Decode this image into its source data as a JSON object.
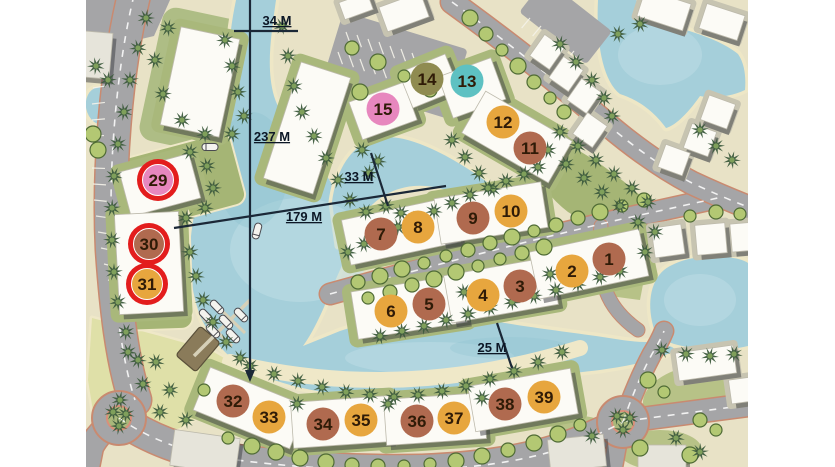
{
  "map_title": "resort lagoon site plan",
  "palette": {
    "bg": "#ffffff",
    "land": "#E8E2C6",
    "water": "#A5CFDA",
    "water_light": "#BFDEE5",
    "water_deep": "#8FC2CF",
    "road": "#A5A5A7",
    "road_edge": "#C98A70",
    "park": "#DFE0A8",
    "green": "#A5B575",
    "green_light": "#B7C287",
    "sand": "#EFE8C8",
    "pad": "#A9B87B",
    "building": "#FCFBF6",
    "building_shadow": "#3A3B40",
    "palm": "#3E5C3E",
    "palm_center": "#7FA05B",
    "bush": "#B3C873",
    "bush_edge": "#4F6B35",
    "line": "#1B2837",
    "label": "#0C1726",
    "marker_text": "#2F1B07"
  },
  "marker_styles": {
    "orange": "#E7A63E",
    "brown": "#B06A4F",
    "teal": "#5EC1C2",
    "olive": "#8F8B51",
    "pink": "#E787BE",
    "ring": "#E31D1D"
  },
  "measurements": [
    {
      "id": "34m",
      "label": "34 M",
      "tx": 277,
      "ty": 25,
      "lines": [
        [
          234,
          31,
          298,
          31
        ]
      ]
    },
    {
      "id": "237m",
      "label": "237 M",
      "tx": 272,
      "ty": 141,
      "lines": [
        [
          250,
          0,
          250,
          374
        ]
      ],
      "arrow": "245,370 255,370 250,382"
    },
    {
      "id": "33m",
      "label": "33 M",
      "tx": 359,
      "ty": 181,
      "lines": [
        [
          371,
          153,
          388,
          206
        ]
      ]
    },
    {
      "id": "179m",
      "label": "179 M",
      "tx": 304,
      "ty": 221,
      "lines": [
        [
          174,
          228,
          446,
          186
        ]
      ]
    },
    {
      "id": "25m",
      "label": "25 M",
      "tx": 492,
      "ty": 352,
      "lines": [
        [
          497,
          323,
          512,
          368
        ]
      ]
    }
  ],
  "markers": [
    {
      "label": "1",
      "x": 609,
      "y": 259,
      "color": "brown",
      "ring": false
    },
    {
      "label": "2",
      "x": 572,
      "y": 271,
      "color": "orange",
      "ring": false
    },
    {
      "label": "3",
      "x": 520,
      "y": 286,
      "color": "brown",
      "ring": false
    },
    {
      "label": "4",
      "x": 483,
      "y": 295,
      "color": "orange",
      "ring": false
    },
    {
      "label": "5",
      "x": 429,
      "y": 304,
      "color": "brown",
      "ring": false
    },
    {
      "label": "6",
      "x": 391,
      "y": 311,
      "color": "orange",
      "ring": false
    },
    {
      "label": "7",
      "x": 381,
      "y": 234,
      "color": "brown",
      "ring": false
    },
    {
      "label": "8",
      "x": 418,
      "y": 227,
      "color": "orange",
      "ring": false
    },
    {
      "label": "9",
      "x": 473,
      "y": 218,
      "color": "brown",
      "ring": false
    },
    {
      "label": "10",
      "x": 511,
      "y": 211,
      "color": "orange",
      "ring": false
    },
    {
      "label": "11",
      "x": 530,
      "y": 148,
      "color": "brown",
      "ring": false
    },
    {
      "label": "12",
      "x": 503,
      "y": 122,
      "color": "orange",
      "ring": false
    },
    {
      "label": "13",
      "x": 467,
      "y": 81,
      "color": "teal",
      "ring": false
    },
    {
      "label": "14",
      "x": 427,
      "y": 79,
      "color": "olive",
      "ring": false
    },
    {
      "label": "15",
      "x": 383,
      "y": 109,
      "color": "pink",
      "ring": false
    },
    {
      "label": "29",
      "x": 158,
      "y": 180,
      "color": "pink",
      "ring": true
    },
    {
      "label": "30",
      "x": 149,
      "y": 244,
      "color": "brown",
      "ring": true
    },
    {
      "label": "31",
      "x": 147,
      "y": 284,
      "color": "orange",
      "ring": true
    },
    {
      "label": "32",
      "x": 233,
      "y": 401,
      "color": "brown",
      "ring": false
    },
    {
      "label": "33",
      "x": 269,
      "y": 417,
      "color": "orange",
      "ring": false
    },
    {
      "label": "34",
      "x": 323,
      "y": 424,
      "color": "brown",
      "ring": false
    },
    {
      "label": "35",
      "x": 361,
      "y": 420,
      "color": "orange",
      "ring": false
    },
    {
      "label": "36",
      "x": 417,
      "y": 421,
      "color": "brown",
      "ring": false
    },
    {
      "label": "37",
      "x": 454,
      "y": 418,
      "color": "orange",
      "ring": false
    },
    {
      "label": "38",
      "x": 505,
      "y": 404,
      "color": "brown",
      "ring": false
    },
    {
      "label": "39",
      "x": 544,
      "y": 397,
      "color": "orange",
      "ring": false
    }
  ],
  "decor": {
    "buildings": [
      [
        200,
        82,
        60,
        100,
        12,
        0
      ],
      [
        96,
        55,
        30,
        46,
        5,
        2
      ],
      [
        307,
        128,
        52,
        122,
        18,
        0
      ],
      [
        383,
        111,
        58,
        40,
        -20,
        0
      ],
      [
        429,
        81,
        50,
        38,
        -22,
        0
      ],
      [
        472,
        88,
        56,
        44,
        -20,
        0
      ],
      [
        517,
        137,
        100,
        48,
        30,
        0
      ],
      [
        401,
        231,
        112,
        46,
        -12,
        0
      ],
      [
        491,
        213,
        108,
        46,
        -9,
        0
      ],
      [
        409,
        307,
        110,
        48,
        -9,
        0
      ],
      [
        501,
        290,
        108,
        48,
        -10,
        0
      ],
      [
        589,
        264,
        112,
        48,
        -12,
        0
      ],
      [
        250,
        408,
        104,
        46,
        22,
        0
      ],
      [
        341,
        422,
        98,
        46,
        -4,
        0
      ],
      [
        435,
        419,
        100,
        46,
        -4,
        0
      ],
      [
        523,
        400,
        104,
        46,
        -10,
        0
      ],
      [
        160,
        185,
        72,
        46,
        -15,
        0
      ],
      [
        149,
        263,
        64,
        100,
        -3,
        0
      ],
      [
        547,
        52,
        24,
        26,
        35,
        1
      ],
      [
        566,
        74,
        24,
        26,
        35,
        1
      ],
      [
        584,
        96,
        24,
        26,
        35,
        1
      ],
      [
        590,
        130,
        24,
        26,
        35,
        1
      ],
      [
        718,
        112,
        28,
        26,
        20,
        1
      ],
      [
        700,
        140,
        26,
        26,
        20,
        1
      ],
      [
        674,
        160,
        26,
        24,
        20,
        1
      ],
      [
        668,
        241,
        30,
        30,
        -8,
        1
      ],
      [
        711,
        239,
        30,
        30,
        -5,
        1
      ],
      [
        744,
        237,
        26,
        28,
        -5,
        1
      ],
      [
        664,
        10,
        48,
        28,
        18,
        1
      ],
      [
        722,
        22,
        40,
        26,
        18,
        1
      ],
      [
        404,
        12,
        44,
        26,
        -20,
        1
      ],
      [
        356,
        6,
        30,
        18,
        -20,
        1
      ],
      [
        706,
        363,
        58,
        28,
        -8,
        1
      ],
      [
        745,
        390,
        30,
        24,
        -8,
        1
      ],
      [
        205,
        452,
        66,
        36,
        8,
        2
      ],
      [
        577,
        453,
        56,
        32,
        -6,
        2
      ],
      [
        662,
        458,
        48,
        26,
        0,
        2
      ]
    ],
    "palms": [
      [
        146,
        18
      ],
      [
        138,
        48
      ],
      [
        130,
        80
      ],
      [
        124,
        112
      ],
      [
        118,
        144
      ],
      [
        114,
        176
      ],
      [
        112,
        208
      ],
      [
        112,
        240
      ],
      [
        114,
        272
      ],
      [
        118,
        302
      ],
      [
        126,
        332
      ],
      [
        138,
        360
      ],
      [
        225,
        40
      ],
      [
        232,
        66
      ],
      [
        238,
        92
      ],
      [
        244,
        116
      ],
      [
        232,
        134
      ],
      [
        168,
        28
      ],
      [
        155,
        60
      ],
      [
        163,
        94
      ],
      [
        182,
        120
      ],
      [
        205,
        134
      ],
      [
        96,
        66
      ],
      [
        108,
        80
      ],
      [
        190,
        152
      ],
      [
        207,
        166
      ],
      [
        213,
        188
      ],
      [
        205,
        208
      ],
      [
        186,
        218
      ],
      [
        190,
        252
      ],
      [
        196,
        276
      ],
      [
        203,
        300
      ],
      [
        213,
        322
      ],
      [
        226,
        342
      ],
      [
        240,
        358
      ],
      [
        282,
        26
      ],
      [
        288,
        56
      ],
      [
        294,
        86
      ],
      [
        302,
        112
      ],
      [
        314,
        136
      ],
      [
        326,
        158
      ],
      [
        338,
        180
      ],
      [
        350,
        200
      ],
      [
        366,
        212
      ],
      [
        362,
        150
      ],
      [
        378,
        161
      ],
      [
        369,
        173
      ],
      [
        452,
        140
      ],
      [
        465,
        157
      ],
      [
        479,
        173
      ],
      [
        493,
        189
      ],
      [
        386,
        206
      ],
      [
        401,
        213
      ],
      [
        348,
        252
      ],
      [
        364,
        244
      ],
      [
        382,
        235
      ],
      [
        398,
        227
      ],
      [
        416,
        219
      ],
      [
        434,
        211
      ],
      [
        452,
        203
      ],
      [
        470,
        195
      ],
      [
        488,
        188
      ],
      [
        506,
        181
      ],
      [
        524,
        174
      ],
      [
        538,
        167
      ],
      [
        380,
        336
      ],
      [
        402,
        331
      ],
      [
        424,
        326
      ],
      [
        446,
        320
      ],
      [
        468,
        314
      ],
      [
        490,
        308
      ],
      [
        512,
        302
      ],
      [
        534,
        296
      ],
      [
        556,
        290
      ],
      [
        578,
        284
      ],
      [
        600,
        277
      ],
      [
        620,
        271
      ],
      [
        548,
        150
      ],
      [
        566,
        164
      ],
      [
        584,
        178
      ],
      [
        602,
        192
      ],
      [
        620,
        206
      ],
      [
        560,
        132
      ],
      [
        578,
        146
      ],
      [
        596,
        160
      ],
      [
        614,
        174
      ],
      [
        632,
        188
      ],
      [
        648,
        202
      ],
      [
        638,
        222
      ],
      [
        250,
        366
      ],
      [
        274,
        374
      ],
      [
        298,
        381
      ],
      [
        322,
        387
      ],
      [
        346,
        392
      ],
      [
        370,
        395
      ],
      [
        394,
        397
      ],
      [
        418,
        395
      ],
      [
        442,
        391
      ],
      [
        466,
        386
      ],
      [
        490,
        379
      ],
      [
        514,
        371
      ],
      [
        538,
        362
      ],
      [
        562,
        352
      ],
      [
        128,
        352
      ],
      [
        156,
        362
      ],
      [
        143,
        384
      ],
      [
        170,
        390
      ],
      [
        120,
        400
      ],
      [
        160,
        412
      ],
      [
        186,
        420
      ],
      [
        113,
        412
      ],
      [
        126,
        414
      ],
      [
        119,
        426
      ],
      [
        617,
        416
      ],
      [
        630,
        418
      ],
      [
        623,
        430
      ],
      [
        676,
        438
      ],
      [
        700,
        452
      ],
      [
        592,
        436
      ],
      [
        662,
        350
      ],
      [
        686,
        354
      ],
      [
        710,
        356
      ],
      [
        734,
        354
      ],
      [
        645,
        252
      ],
      [
        655,
        232
      ],
      [
        560,
        44
      ],
      [
        576,
        62
      ],
      [
        592,
        80
      ],
      [
        604,
        98
      ],
      [
        612,
        116
      ],
      [
        700,
        130
      ],
      [
        716,
        146
      ],
      [
        732,
        160
      ],
      [
        640,
        24
      ],
      [
        618,
        34
      ],
      [
        297,
        404
      ],
      [
        388,
        404
      ],
      [
        482,
        398
      ],
      [
        464,
        292
      ],
      [
        550,
        274
      ]
    ],
    "bushes": [
      [
        358,
        282
      ],
      [
        380,
        276
      ],
      [
        402,
        269
      ],
      [
        424,
        263
      ],
      [
        446,
        256
      ],
      [
        468,
        250
      ],
      [
        490,
        243
      ],
      [
        512,
        237
      ],
      [
        534,
        231
      ],
      [
        556,
        225
      ],
      [
        578,
        218
      ],
      [
        600,
        212
      ],
      [
        622,
        206
      ],
      [
        644,
        200
      ],
      [
        368,
        298
      ],
      [
        390,
        292
      ],
      [
        412,
        285
      ],
      [
        434,
        279
      ],
      [
        456,
        272
      ],
      [
        478,
        266
      ],
      [
        500,
        259
      ],
      [
        522,
        253
      ],
      [
        544,
        247
      ],
      [
        228,
        438
      ],
      [
        252,
        446
      ],
      [
        276,
        452
      ],
      [
        300,
        458
      ],
      [
        326,
        462
      ],
      [
        352,
        465
      ],
      [
        378,
        466
      ],
      [
        404,
        466
      ],
      [
        430,
        464
      ],
      [
        456,
        461
      ],
      [
        482,
        456
      ],
      [
        508,
        450
      ],
      [
        534,
        443
      ],
      [
        558,
        434
      ],
      [
        580,
        425
      ],
      [
        470,
        18
      ],
      [
        486,
        34
      ],
      [
        502,
        50
      ],
      [
        518,
        66
      ],
      [
        534,
        82
      ],
      [
        550,
        98
      ],
      [
        564,
        112
      ],
      [
        352,
        48
      ],
      [
        378,
        62
      ],
      [
        404,
        76
      ],
      [
        430,
        90
      ],
      [
        360,
        92
      ],
      [
        386,
        106
      ],
      [
        648,
        380
      ],
      [
        664,
        392
      ],
      [
        700,
        420
      ],
      [
        716,
        430
      ],
      [
        690,
        455
      ],
      [
        640,
        448
      ],
      [
        690,
        216
      ],
      [
        716,
        212
      ],
      [
        740,
        214
      ],
      [
        93,
        134
      ],
      [
        98,
        150
      ],
      [
        204,
        390
      ]
    ],
    "boats": [
      [
        210,
        147,
        90
      ],
      [
        257,
        231,
        15
      ],
      [
        206,
        316,
        -44
      ],
      [
        217,
        307,
        -44
      ],
      [
        213,
        331,
        -44
      ],
      [
        226,
        322,
        -44
      ],
      [
        241,
        315,
        -44
      ],
      [
        233,
        336,
        -44
      ]
    ],
    "parking_ticks": [
      [
        98,
        40,
        -15
      ],
      [
        96,
        56,
        -13
      ],
      [
        94,
        72,
        -11
      ],
      [
        93,
        88,
        -9
      ],
      [
        92,
        104,
        -7
      ],
      [
        92,
        120,
        -5
      ],
      [
        91,
        136,
        -2
      ],
      [
        91,
        152,
        0
      ],
      [
        92,
        168,
        2
      ],
      [
        93,
        184,
        4
      ],
      [
        94,
        200,
        6
      ],
      [
        96,
        216,
        8
      ],
      [
        98,
        232,
        10
      ],
      [
        101,
        248,
        12
      ],
      [
        104,
        264,
        14
      ],
      [
        108,
        280,
        16
      ],
      [
        112,
        296,
        18
      ],
      [
        117,
        312,
        20
      ],
      [
        338,
        52,
        70
      ],
      [
        349,
        55,
        70
      ],
      [
        360,
        59,
        70
      ],
      [
        371,
        62,
        70
      ],
      [
        382,
        66,
        70
      ],
      [
        393,
        69,
        70
      ],
      [
        404,
        73,
        70
      ],
      [
        415,
        76,
        70
      ],
      [
        426,
        80,
        70
      ],
      [
        437,
        83,
        70
      ],
      [
        346,
        32,
        70
      ],
      [
        357,
        35,
        70
      ],
      [
        368,
        39,
        70
      ],
      [
        379,
        42,
        70
      ],
      [
        390,
        46,
        70
      ],
      [
        401,
        49,
        70
      ],
      [
        412,
        53,
        70
      ],
      [
        423,
        56,
        70
      ],
      [
        434,
        60,
        70
      ],
      [
        530,
        18,
        130
      ],
      [
        541,
        26,
        130
      ],
      [
        552,
        34,
        130
      ],
      [
        563,
        43,
        130
      ],
      [
        574,
        51,
        130
      ]
    ]
  }
}
